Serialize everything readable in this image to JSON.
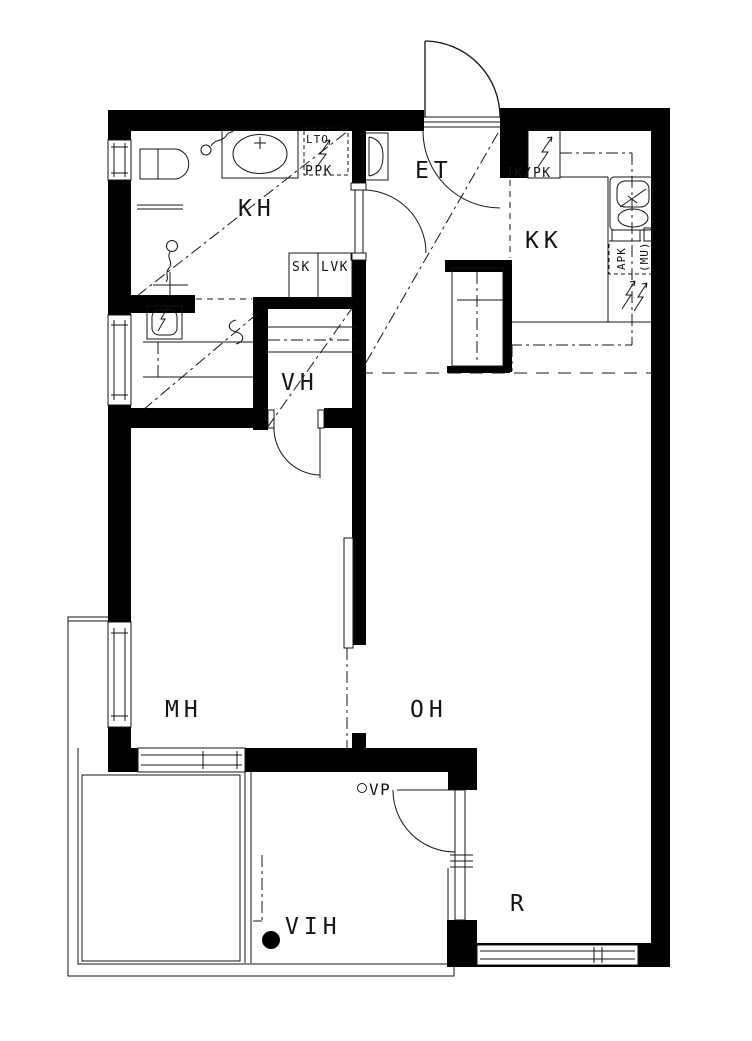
{
  "drawing": {
    "type": "apartment-floor-plan",
    "colors": {
      "wall": "#000000",
      "background": "#ffffff",
      "line": "#141414"
    }
  },
  "rooms": {
    "kh": {
      "label": "KH"
    },
    "et": {
      "label": "ET"
    },
    "kk": {
      "label": "KK"
    },
    "vh": {
      "label": "VH"
    },
    "mh": {
      "label": "MH"
    },
    "oh": {
      "label": "OH"
    },
    "vih": {
      "label": "VIH"
    },
    "r": {
      "label": "R"
    }
  },
  "fixtures": {
    "lto": {
      "label": "LTO"
    },
    "ppk": {
      "label": "PPK"
    },
    "sk": {
      "label": "SK"
    },
    "lvk": {
      "label": "LVK"
    },
    "jkpk": {
      "label": "JK/PK"
    },
    "apk": {
      "label": "APK"
    },
    "mu": {
      "label": "(MU)"
    },
    "vp": {
      "label": "VP"
    }
  }
}
